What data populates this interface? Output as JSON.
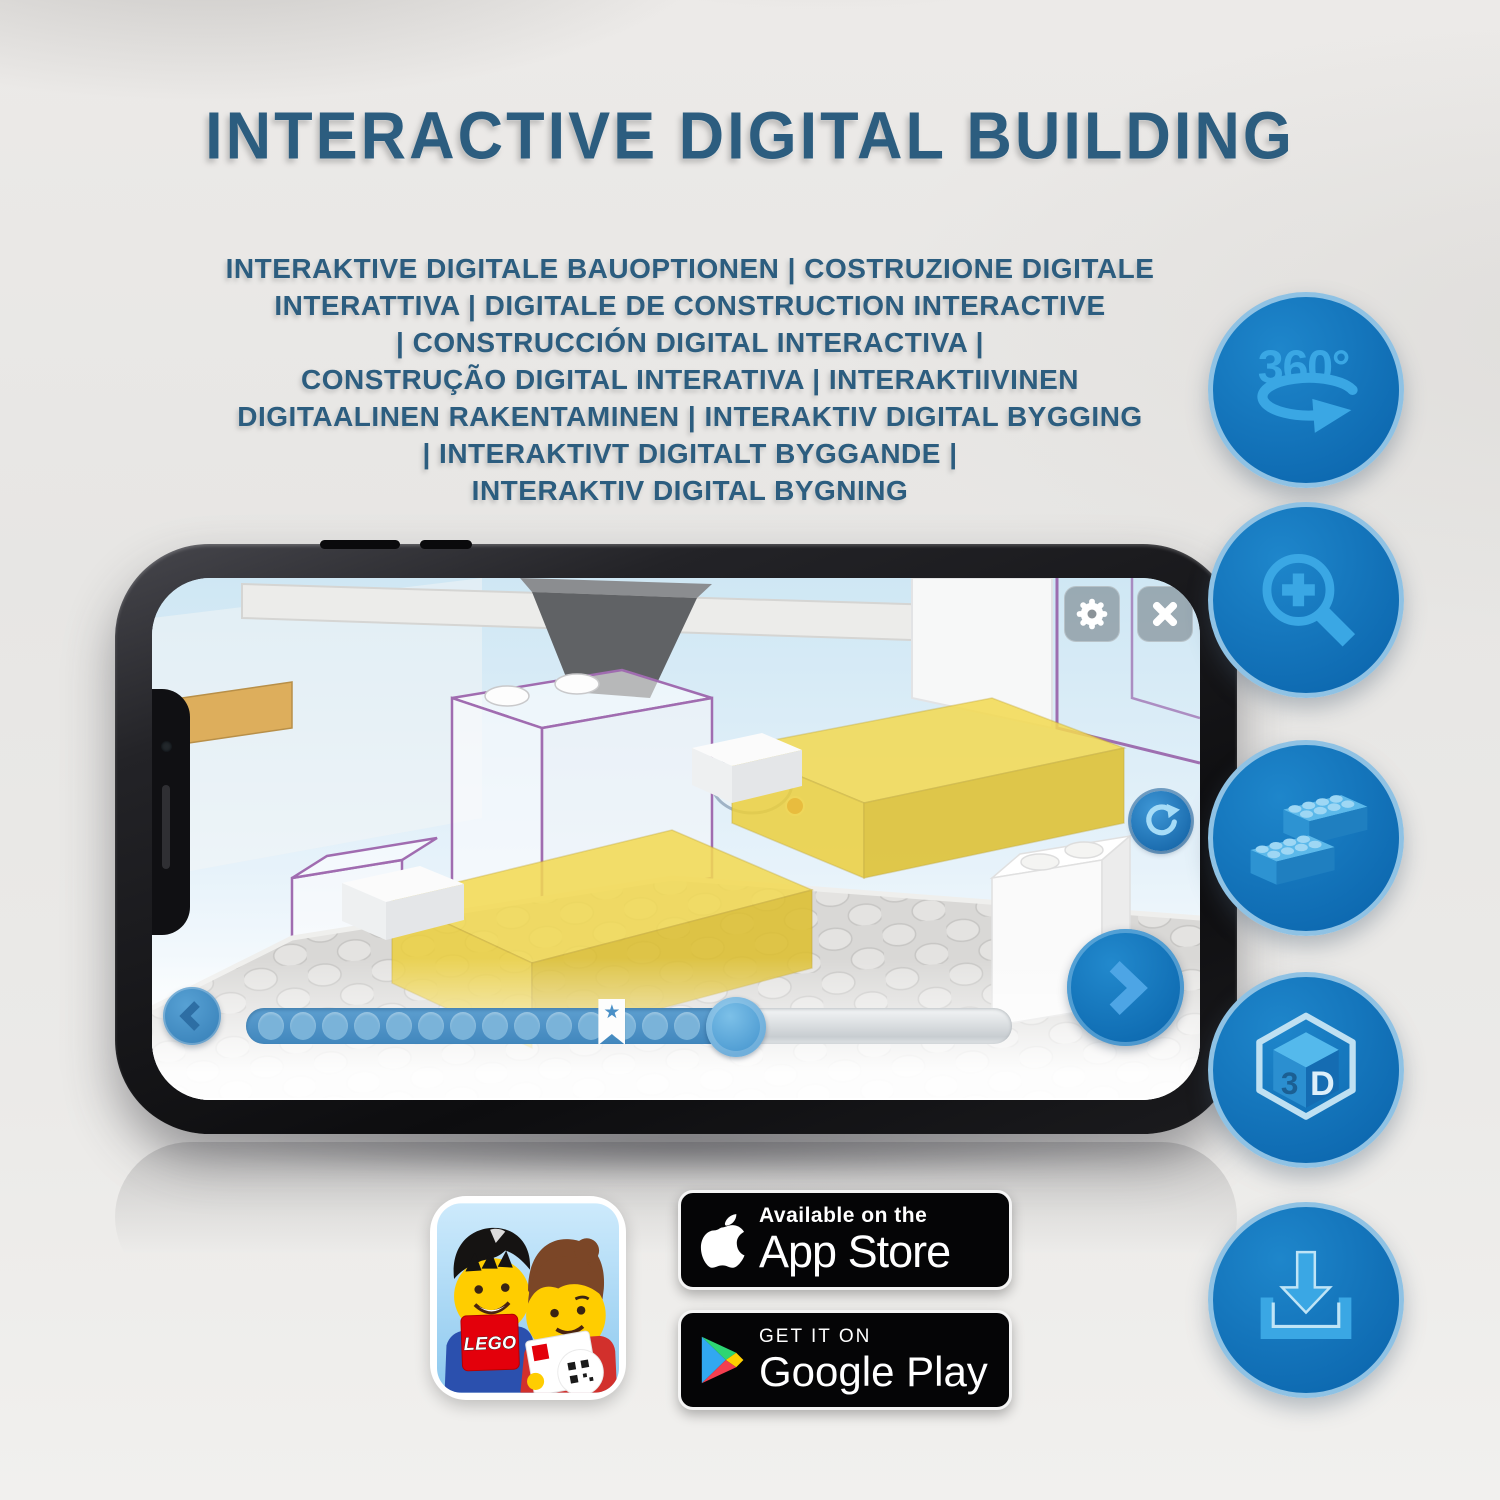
{
  "header": {
    "title": "INTERACTIVE DIGITAL BUILDING",
    "subtitle_lines": [
      "INTERAKTIVE DIGITALE BAUOPTIONEN | COSTRUZIONE DIGITALE",
      "INTERATTIVA | DIGITALE DE CONSTRUCTION INTERACTIVE",
      "| CONSTRUCCIÓN DIGITAL INTERACTIVA |",
      "CONSTRUÇÃO DIGITAL INTERATIVA | INTERAKTIIVINEN",
      "DIGITAALINEN RAKENTAMINEN | INTERAKTIV DIGITAL BYGGING",
      "| INTERAKTIVT DIGITALT BYGGANDE |",
      "INTERAKTIV DIGITAL BYGNING"
    ]
  },
  "phone": {
    "app_ui": {
      "icons": {
        "settings": "gear",
        "close": "x",
        "rotate": "rotate-clockwise-arrow",
        "previous": "chevron-left",
        "next": "chevron-right",
        "star_marker": "★"
      },
      "progress": {
        "dot_count": 15,
        "filled_percent": 64,
        "bookmark_percent": 46
      }
    }
  },
  "feature_icons": [
    {
      "name": "360-rotation",
      "label": "360°"
    },
    {
      "name": "zoom-in-magnifier"
    },
    {
      "name": "lego-bricks"
    },
    {
      "name": "3d-cube",
      "label_left": "3",
      "label_right": "D"
    },
    {
      "name": "download"
    }
  ],
  "store_badges": {
    "app_store": {
      "tagline": "Available on the",
      "store": "App Store"
    },
    "google_play": {
      "tagline": "GET IT ON",
      "store": "Google Play"
    }
  },
  "app_icon": {
    "logo": "LEGO"
  },
  "colors": {
    "title_blue": "#2c5d7f",
    "feature_circle_blue": "#1478be",
    "feature_icon_light_blue": "#3aa7e4",
    "slider_blue": "#4a90c4",
    "bed_yellow": "#f3da52",
    "badge_black": "#050506",
    "lego_red": "#e3000b"
  }
}
